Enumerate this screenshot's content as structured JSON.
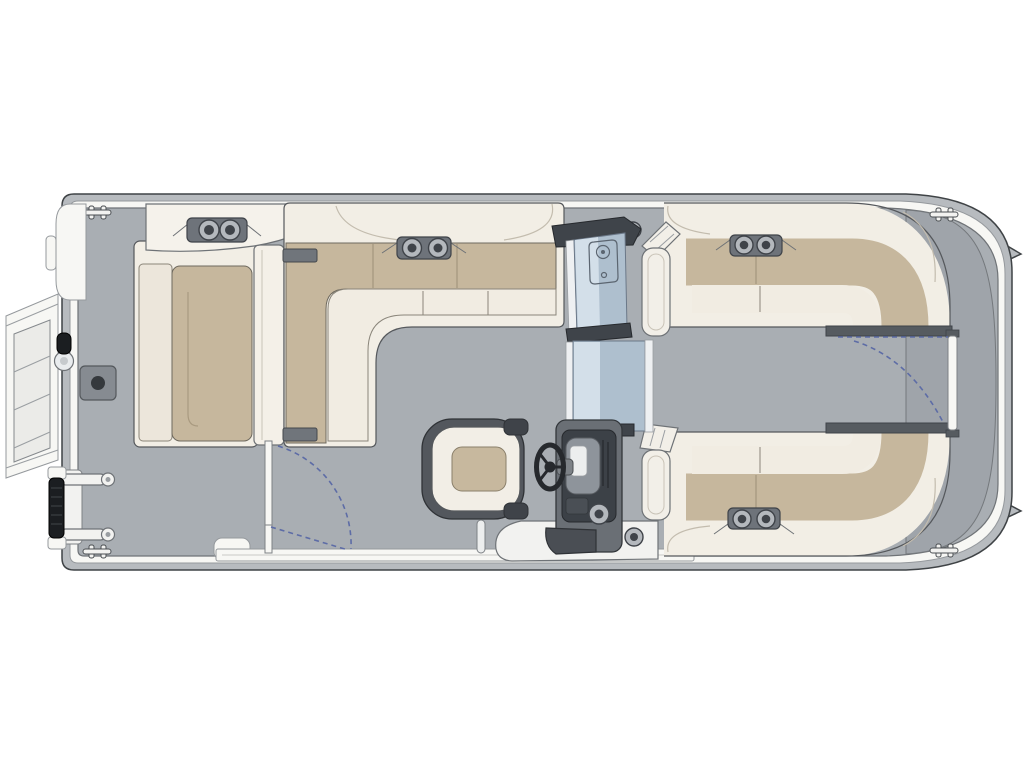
{
  "meta": {
    "aria_label": "Pontoon boat floor plan, top-down view",
    "view": "top-down",
    "background": "#ffffff"
  },
  "palette": {
    "outline": "#3f4346",
    "hull": "#b7bbbf",
    "rim": "#f7f7f4",
    "deck": "#a9aeb3",
    "cap": "#9fa4aa",
    "cushion_cream": "#f2eee5",
    "cushion_face": "#f1ece2",
    "tan": "#c6b79d",
    "tan_line": "#6e695e",
    "console_dark": "#3c4147",
    "console_mid": "#6a6f75",
    "metal": "#8e949b",
    "glass": "#aebfce",
    "glass_light": "#d3dfe9",
    "glass_frame": "#3f444a",
    "hardware": "#6e737a",
    "hardware_ring": "#b4b8bd",
    "hardware_dot": "#3f4349",
    "black": "#1b1e21",
    "arc_blue": "#5d6ca6",
    "stitch": "#a99a80",
    "white": "#f2f2f0"
  },
  "components": {
    "hull": [
      "pontoon-hull",
      "rub-rail",
      "deck",
      "stern-cap",
      "cleats"
    ],
    "bow": [
      "boarding-platform",
      "bow-gate-panel",
      "boarding-ladder",
      "ladder-grip",
      "deck-hatch",
      "light-pole-knob"
    ],
    "seating": [
      "bow-lounger",
      "port-forward-l-bench",
      "starboard-forward-bench",
      "starboard-aft-bench",
      "captains-chair"
    ],
    "helm": [
      "helm-console",
      "steering-wheel",
      "dashboard",
      "footrest",
      "windshield",
      "walkthrough-door"
    ],
    "gates": [
      "port-side-gate",
      "stern-gate"
    ],
    "gate_indicator": "dashed-swing-arc"
  },
  "features": {
    "cupholder_pairs": 4,
    "speaker_grilles": 3,
    "steering_wheel": 1,
    "captains_chair": 1,
    "swing_gates": 2,
    "cleats": 4
  }
}
